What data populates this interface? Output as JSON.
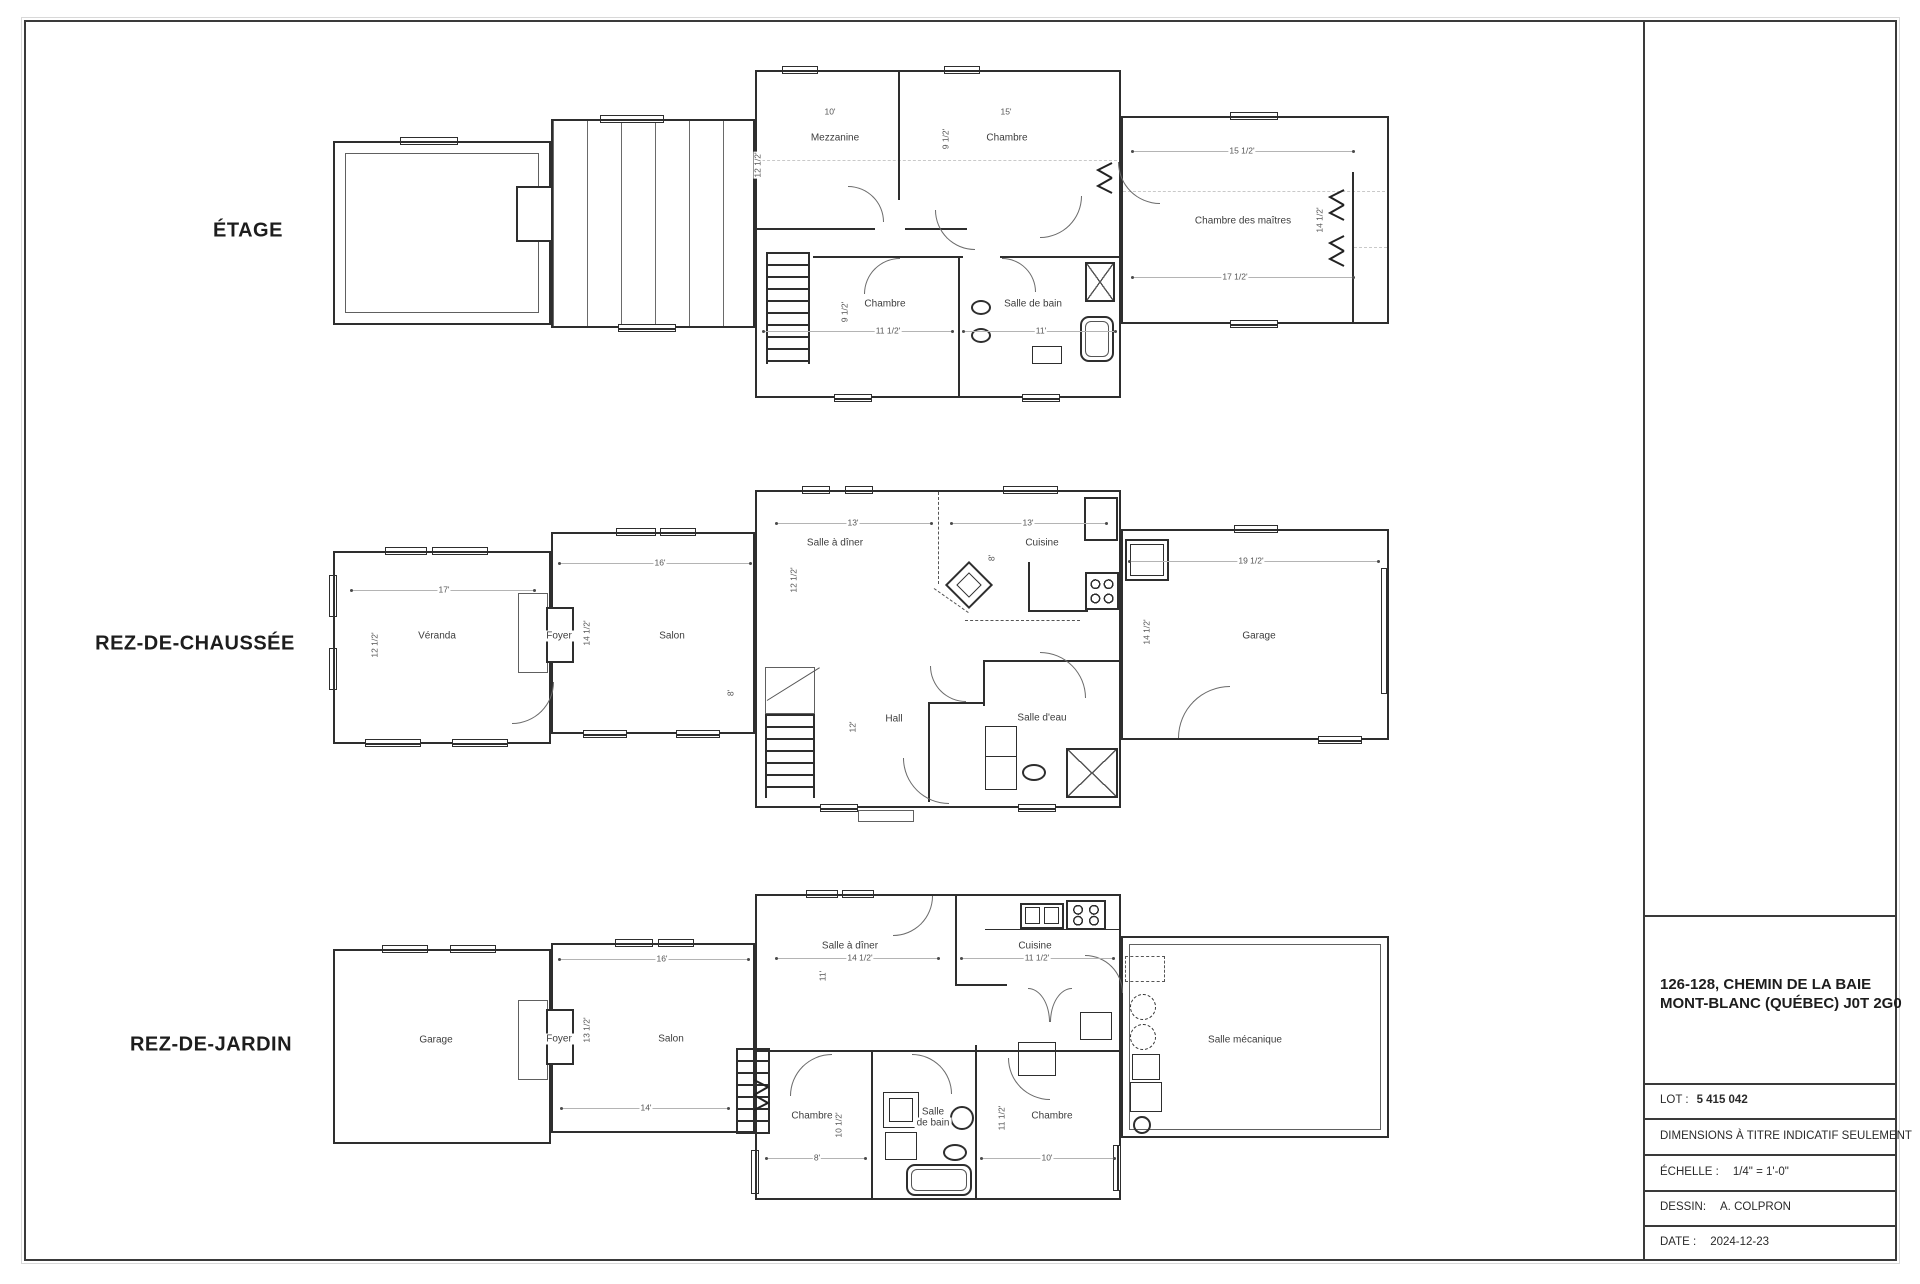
{
  "title_block": {
    "address_line1": "126-128, CHEMIN DE LA BAIE",
    "address_line2": "MONT-BLANC (QUÉBEC)  J0T 2G0",
    "lot_label": "LOT :",
    "lot_value": "5 415 042",
    "note": "DIMENSIONS À TITRE INDICATIF SEULEMENT",
    "scale_label": "ÉCHELLE :",
    "scale_value": "1/4\" = 1'-0\"",
    "dessin_label": "DESSIN:",
    "dessin_value": "A. COLPRON",
    "date_label": "DATE :",
    "date_value": "2024-12-23"
  },
  "floors": {
    "etage": {
      "name": "ÉTAGE",
      "rooms": {
        "mezzanine": "Mezzanine",
        "chambre": "Chambre",
        "chambre_b": "Chambre",
        "salle_de_bain": "Salle de bain",
        "maitres": "Chambre des maîtres"
      },
      "dims": [
        "10'",
        "15'",
        "12 1/2'",
        "9 1/2'",
        "9 1/2'",
        "11 1/2'",
        "11'",
        "15 1/2'",
        "14 1/2'",
        "17 1/2'"
      ]
    },
    "rdc": {
      "name": "REZ-DE-CHAUSSÉE",
      "rooms": {
        "veranda": "Véranda",
        "foyer": "Foyer",
        "salon": "Salon",
        "salle_a_diner": "Salle à dîner",
        "cuisine": "Cuisine",
        "hall": "Hall",
        "salle_d_eau": "Salle d'eau",
        "garage": "Garage"
      },
      "dims": [
        "17'",
        "12 1/2'",
        "16'",
        "14 1/2'",
        "8'",
        "13'",
        "12 1/2'",
        "13'",
        "8'",
        "12'",
        "19 1/2'",
        "14 1/2'"
      ]
    },
    "rdj": {
      "name": "REZ-DE-JARDIN",
      "rooms": {
        "garage": "Garage",
        "foyer": "Foyer",
        "salon": "Salon",
        "salle_a_diner": "Salle à dîner",
        "cuisine": "Cuisine",
        "chambre_g": "Chambre",
        "salle_de_bain_1": "Salle",
        "salle_de_bain_2": "de bain",
        "chambre_d": "Chambre",
        "mecanique": "Salle mécanique"
      },
      "dims": [
        "16'",
        "13 1/2'",
        "14'",
        "14 1/2'",
        "11'",
        "11 1/2'",
        "8'",
        "10 1/2'",
        "11 1/2'",
        "10'"
      ]
    }
  }
}
